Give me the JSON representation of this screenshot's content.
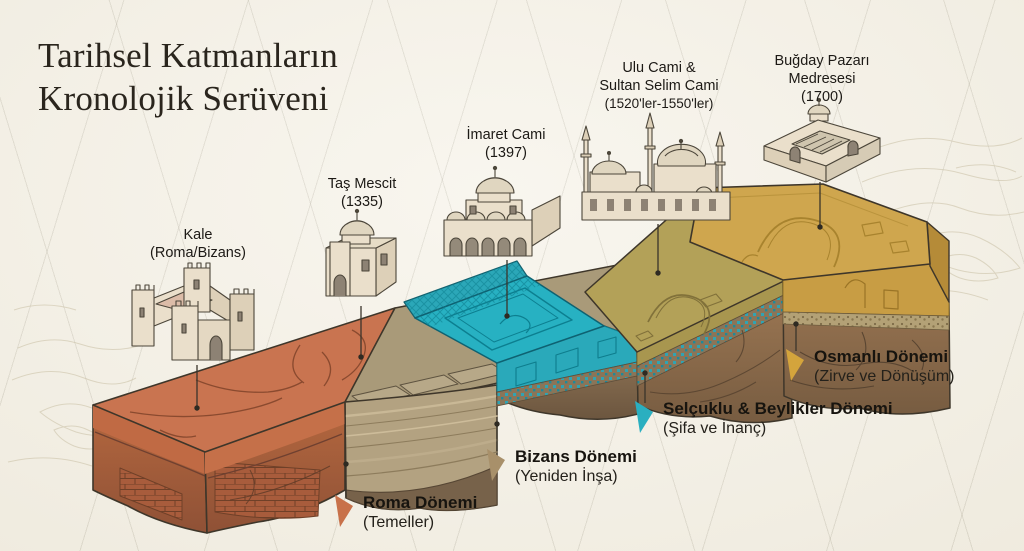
{
  "title": {
    "line1": "Tarihsel Katmanların",
    "line2": "Kronolojik Serüveni"
  },
  "buildings": [
    {
      "id": "kale",
      "line1": "Kale",
      "line2": "(Roma/Bizans)"
    },
    {
      "id": "tas-mescit",
      "line1": "Taş Mescit",
      "line2": "(1335)"
    },
    {
      "id": "imaret-cami",
      "line1": "İmaret Cami",
      "line2": "(1397)"
    },
    {
      "id": "ulu-cami",
      "line1": "Ulu Cami &",
      "line2": "Sultan Selim Cami",
      "line3": "(1520'ler-1550'ler)"
    },
    {
      "id": "bugday-pazari",
      "line1": "Buğday Pazarı",
      "line2": "Medresesi",
      "line3": "(1700)"
    }
  ],
  "periods": [
    {
      "id": "roma",
      "name": "Roma Dönemi",
      "subtitle": "(Temeller)",
      "marker_color": "#c8714a"
    },
    {
      "id": "bizans",
      "name": "Bizans Dönemi",
      "subtitle": "(Yeniden İnşa)",
      "marker_color": "#a8906a"
    },
    {
      "id": "selcuklu",
      "name": "Selçuklu & Beylikler Dönemi",
      "subtitle": "(Şifa ve İnanç)",
      "marker_color": "#2aafc0"
    },
    {
      "id": "osmanli",
      "name": "Osmanlı Dönemi",
      "subtitle": "(Zirve ve Dönüşüm)",
      "marker_color": "#d4a43c"
    }
  ],
  "layer_palette": {
    "background": "#f5f1e6",
    "roma_top": "#c97450",
    "roma_face": "#a75c3d",
    "bizans_top": "#a99a79",
    "bizans_face": "#b3a281",
    "selcuklu_top": "#27b1c2",
    "osmanli_early_top": "#b3a158",
    "osmanli_top": "#cfa64e",
    "sediment": "#8d7254",
    "outline": "#3e362a"
  }
}
